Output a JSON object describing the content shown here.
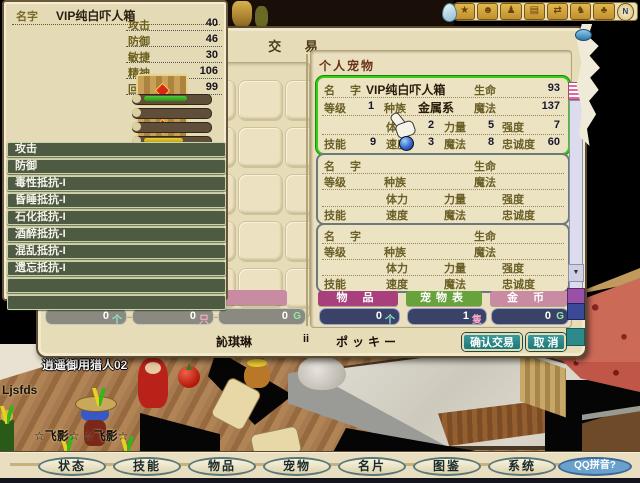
{
  "colors": {
    "selection_green": "#38cc14",
    "header_magenta": "#a8407e",
    "header_green": "#68a23c",
    "header_pink": "#c98ba2",
    "value_bar_navy": "#3a4268",
    "value_bar_gray": "#8a8a80",
    "confirm_teal": "#2a8888",
    "window_beige": "#e6dcb8",
    "skill_row_green": "#4e5a42"
  },
  "stats_panel": {
    "name_label": "名字",
    "name_value": "VIP纯白吓人箱",
    "attributes": [
      {
        "label": "攻击",
        "value": "40"
      },
      {
        "label": "防御",
        "value": "46"
      },
      {
        "label": "敏捷",
        "value": "30"
      },
      {
        "label": "精神",
        "value": "106"
      },
      {
        "label": "回复",
        "value": "99"
      }
    ],
    "gauges": [
      {
        "fill": 0.55
      },
      {
        "fill": 0
      },
      {
        "fill": 0
      },
      {
        "fill": 0.5
      }
    ],
    "skills": [
      "攻击",
      "防御",
      "毒性抵抗-I",
      "昏睡抵抗-I",
      "石化抵抗-I",
      "酒醉抵抗-I",
      "混乱抵抗-I",
      "遗忘抵抗-I",
      "",
      ""
    ]
  },
  "trade_window": {
    "title": "交 易",
    "left": {
      "gold_header": "金币",
      "counts": [
        {
          "value": "0",
          "unit": "个"
        },
        {
          "value": "0",
          "unit": "只"
        },
        {
          "value": "0",
          "unit": "G"
        }
      ]
    },
    "right": {
      "title": "个人宠物",
      "labels": {
        "name1": "名",
        "name2": "字",
        "life": "生命",
        "level": "等级",
        "race": "种族",
        "magic": "魔法",
        "stamina": "体力",
        "strength": "力量",
        "power": "强度",
        "skill": "技能",
        "speed": "速度",
        "loyalty": "忠诚度"
      },
      "pets": [
        {
          "name": "VIP纯白吓人箱",
          "life": "93",
          "level": "1",
          "race": "金属系",
          "magic": "137",
          "stamina": "2",
          "strength": "5",
          "power": "7",
          "skill": "9",
          "speed": "3",
          "magic2": "8",
          "loyalty": "60"
        },
        {
          "name": "",
          "life": "",
          "level": "",
          "race": "",
          "magic": "",
          "stamina": "",
          "strength": "",
          "power": "",
          "skill": "",
          "speed": "",
          "magic2": "",
          "loyalty": ""
        },
        {
          "name": "",
          "life": "",
          "level": "",
          "race": "",
          "magic": "",
          "stamina": "",
          "strength": "",
          "power": "",
          "skill": "",
          "speed": "",
          "magic2": "",
          "loyalty": ""
        }
      ],
      "headers": [
        {
          "label": "物 品"
        },
        {
          "label": "宠物表"
        },
        {
          "label": "金 币"
        }
      ],
      "counts": [
        {
          "value": "0",
          "unit": "个"
        },
        {
          "value": "1",
          "unit": "隻"
        },
        {
          "value": "0",
          "unit": "G"
        }
      ]
    },
    "traders": {
      "left_name": "訫琪琳",
      "middle": "ii",
      "right_name": "ポッキー"
    },
    "buttons": {
      "confirm": "确认交易",
      "cancel": "取 消"
    }
  },
  "icon_bar": {
    "icons": [
      {
        "name": "action-icon",
        "glyph": "★"
      },
      {
        "name": "chat-icon",
        "glyph": "☻"
      },
      {
        "name": "party-icon",
        "glyph": "♟"
      },
      {
        "name": "namecard-icon",
        "glyph": "▤"
      },
      {
        "name": "trade-icon",
        "glyph": "⇄"
      },
      {
        "name": "team-icon",
        "glyph": "♞"
      },
      {
        "name": "emote-icon",
        "glyph": "♣"
      },
      {
        "name": "compass-icon",
        "glyph": "N"
      }
    ]
  },
  "menu_bar": {
    "items": [
      "状态",
      "技能",
      "物品",
      "宠物",
      "名片",
      "图鉴",
      "系统"
    ],
    "ime_button": "QQ拼音?"
  },
  "scene": {
    "player_label": "逍遥御用猎人02",
    "floor_label": "Ljsfds",
    "pet_label": "☆飞影☆ ☆飞影☆"
  }
}
